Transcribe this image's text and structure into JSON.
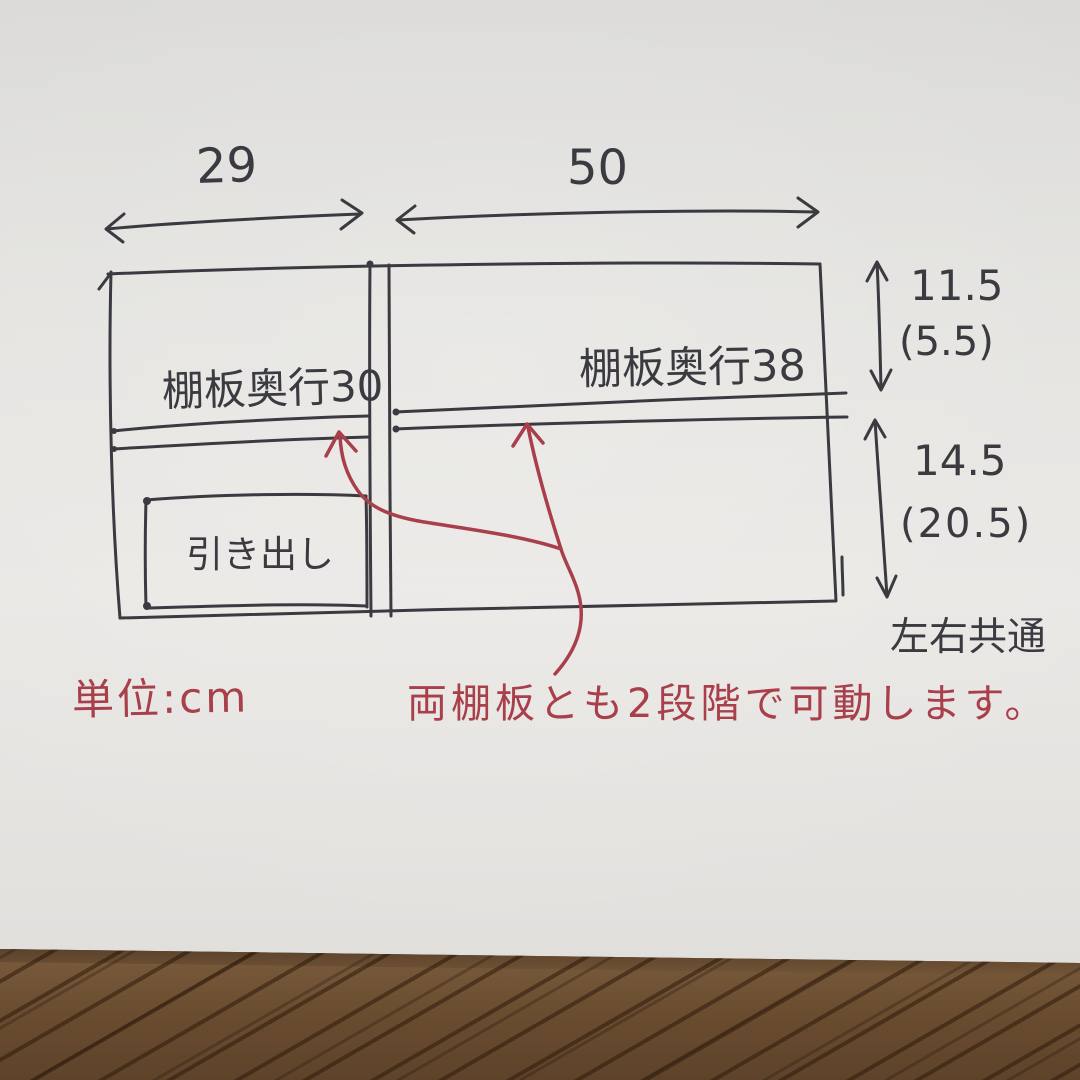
{
  "colors": {
    "ink": "#3b3a40",
    "red_ink": "#a83f4a",
    "paper": "#e6e4e1",
    "wood_floor": "#74553a"
  },
  "dimensions": {
    "top_width_left": "29",
    "top_width_right": "50",
    "right_height_upper": "11.5",
    "right_height_upper_paren": "(5.5)",
    "right_height_lower": "14.5",
    "right_height_lower_paren": "(20.5)"
  },
  "labels": {
    "shelf_depth_left": "棚板奥行30",
    "shelf_depth_right": "棚板奥行38",
    "drawer": "引き出し",
    "sides_common": "左右共通"
  },
  "notes": {
    "unit": "単位:cm",
    "movable": "両棚板とも2段階で可動します。"
  }
}
